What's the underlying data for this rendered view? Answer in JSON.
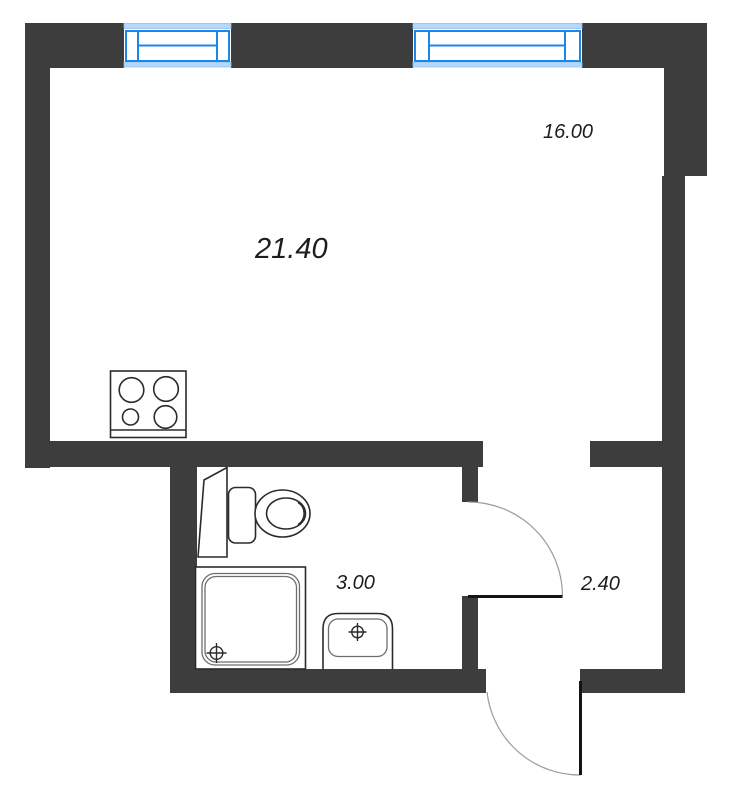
{
  "areas": {
    "total": "21.40",
    "living": "16.00",
    "bathroom": "3.00",
    "hallway": "2.40"
  },
  "colors": {
    "wall": "#3d3d3d",
    "window-frame": "#1d87e8",
    "window-band": "#b5d8f8",
    "window-band-edge": "#8fc0f2",
    "fixture": "#2b2b2b",
    "fixture-light": "#6e6e6e",
    "door-arc": "#9c9c9c",
    "door-leaf": "#141414",
    "label": "#1d1d1d",
    "floor": "#ffffff"
  }
}
